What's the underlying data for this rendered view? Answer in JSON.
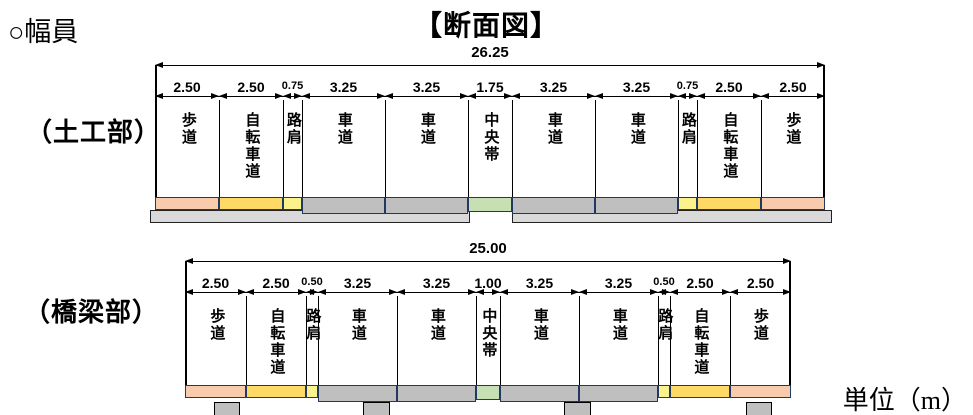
{
  "page": {
    "title": "【断面図】",
    "width_heading": "○幅員",
    "unit_label": "単位（m）"
  },
  "colors": {
    "sidewalk": "#F8CBAD",
    "bicycle": "#FFD966",
    "shoulder": "#FCF28C",
    "roadway": "#BFBFBF",
    "median": "#C6E0B4",
    "deck_border": "#1F3864",
    "base": "#D9D9D9"
  },
  "sections": [
    {
      "name_label": "（土工部）",
      "total": "26.25",
      "segments": [
        {
          "width": "2.50",
          "label": "歩道",
          "type": "sidewalk"
        },
        {
          "width": "2.50",
          "label": "自転車道",
          "type": "bicycle"
        },
        {
          "width": "0.75",
          "label": "路肩",
          "type": "shoulder"
        },
        {
          "width": "3.25",
          "label": "車道",
          "type": "roadway"
        },
        {
          "width": "3.25",
          "label": "車道",
          "type": "roadway"
        },
        {
          "width": "1.75",
          "label": "中央帯",
          "type": "median"
        },
        {
          "width": "3.25",
          "label": "車道",
          "type": "roadway"
        },
        {
          "width": "3.25",
          "label": "車道",
          "type": "roadway"
        },
        {
          "width": "0.75",
          "label": "路肩",
          "type": "shoulder"
        },
        {
          "width": "2.50",
          "label": "自転車道",
          "type": "bicycle"
        },
        {
          "width": "2.50",
          "label": "歩道",
          "type": "sidewalk"
        }
      ]
    },
    {
      "name_label": "（橋梁部）",
      "total": "25.00",
      "segments": [
        {
          "width": "2.50",
          "label": "歩道",
          "type": "sidewalk"
        },
        {
          "width": "2.50",
          "label": "自転車道",
          "type": "bicycle"
        },
        {
          "width": "0.50",
          "label": "路肩",
          "type": "shoulder"
        },
        {
          "width": "3.25",
          "label": "車道",
          "type": "roadway"
        },
        {
          "width": "3.25",
          "label": "車道",
          "type": "roadway"
        },
        {
          "width": "1.00",
          "label": "中央帯",
          "type": "median"
        },
        {
          "width": "3.25",
          "label": "車道",
          "type": "roadway"
        },
        {
          "width": "3.25",
          "label": "車道",
          "type": "roadway"
        },
        {
          "width": "0.50",
          "label": "路肩",
          "type": "shoulder"
        },
        {
          "width": "2.50",
          "label": "自転車道",
          "type": "bicycle"
        },
        {
          "width": "2.50",
          "label": "歩道",
          "type": "sidewalk"
        }
      ]
    }
  ]
}
